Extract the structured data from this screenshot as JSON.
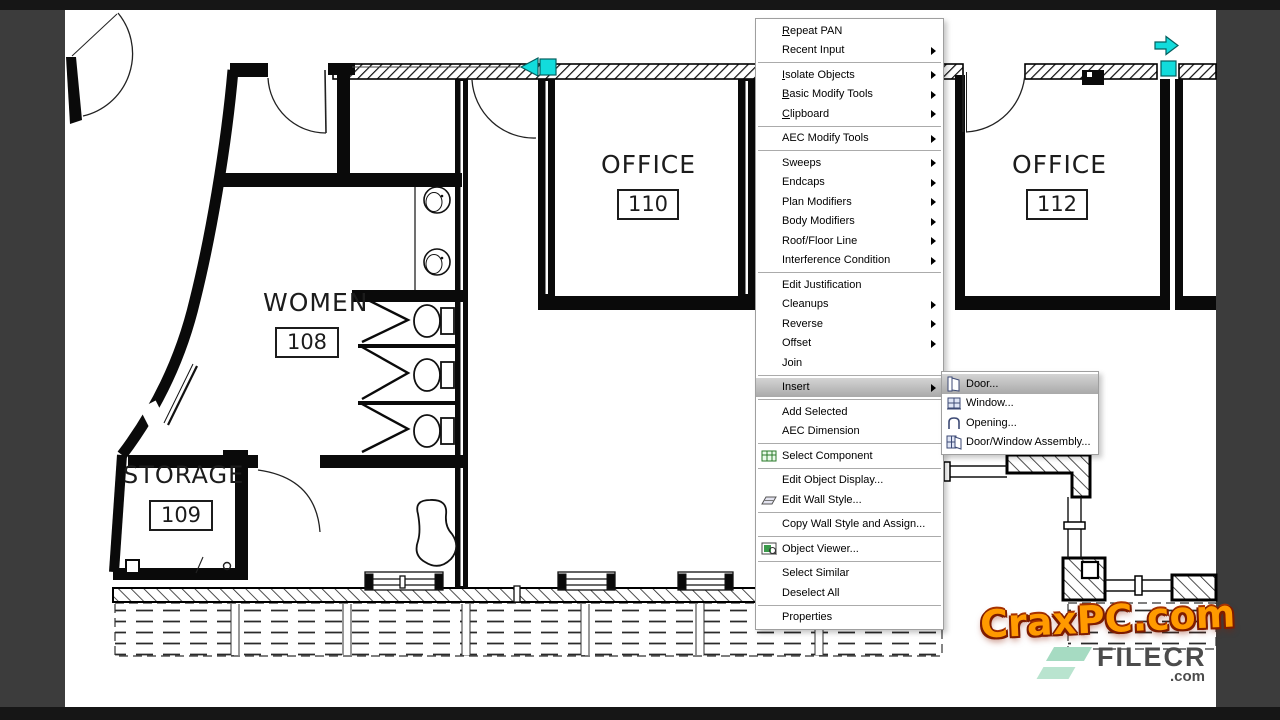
{
  "frame": {
    "border_color": "#3c3c3c",
    "strip_color": "#161616",
    "canvas_color": "#ffffff"
  },
  "floor_plan": {
    "rooms": [
      {
        "name": "OFFICE",
        "number": "110"
      },
      {
        "name": "OFFICE",
        "number": "112"
      },
      {
        "name": "WOMEN",
        "number": "108"
      },
      {
        "name": "STORAGE",
        "number": "109"
      }
    ],
    "selection": {
      "grip_color": "#12dcdc",
      "line_color": "#0a0a0a"
    }
  },
  "context_menu": {
    "items": [
      {
        "u": "R",
        "rest": "epeat PAN"
      },
      {
        "u": "",
        "rest": "Recent Input"
      },
      {
        "u": "I",
        "rest": "solate Objects"
      },
      {
        "u": "B",
        "rest": "asic Modify Tools"
      },
      {
        "u": "C",
        "rest": "lipboard"
      },
      {
        "u": "",
        "rest": "AEC Modify Tools"
      },
      {
        "u": "",
        "rest": "Sweeps"
      },
      {
        "u": "",
        "rest": "Endcaps"
      },
      {
        "u": "",
        "rest": "Plan Modifiers"
      },
      {
        "u": "",
        "rest": "Body Modifiers"
      },
      {
        "u": "",
        "rest": "Roof/Floor Line"
      },
      {
        "u": "",
        "rest": "Interference Condition"
      },
      {
        "u": "",
        "rest": "Edit Justification"
      },
      {
        "u": "",
        "rest": "Cleanups"
      },
      {
        "u": "",
        "rest": "Reverse"
      },
      {
        "u": "",
        "rest": "Offset"
      },
      {
        "u": "",
        "rest": "Join"
      },
      {
        "u": "",
        "rest": "Insert"
      },
      {
        "u": "",
        "rest": "Add Selected"
      },
      {
        "u": "",
        "rest": "AEC Dimension"
      },
      {
        "u": "",
        "rest": "Select Component"
      },
      {
        "u": "",
        "rest": "Edit Object Display..."
      },
      {
        "u": "",
        "rest": "Edit Wall Style..."
      },
      {
        "u": "",
        "rest": "Copy Wall Style and Assign..."
      },
      {
        "u": "",
        "rest": "Object Viewer..."
      },
      {
        "u": "",
        "rest": "Select Similar"
      },
      {
        "u": "",
        "rest": "Deselect All"
      },
      {
        "u": "",
        "rest": "Properties"
      }
    ],
    "highlighted_item": "Insert"
  },
  "submenu": {
    "items": [
      {
        "label": "Door..."
      },
      {
        "label": "Window..."
      },
      {
        "label": "Opening..."
      },
      {
        "label": "Door/Window Assembly..."
      }
    ],
    "highlighted_item": "Door..."
  },
  "watermarks": {
    "crax_text": "CraxPC.com",
    "filecr_text": "FILECR",
    "filecr_tld": ".com"
  }
}
